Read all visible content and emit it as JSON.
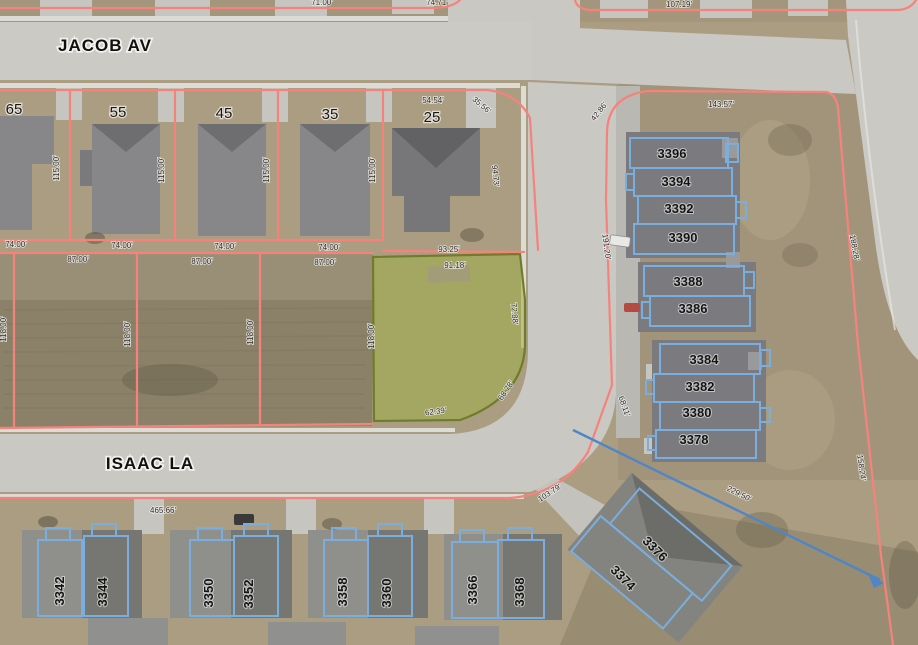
{
  "colors": {
    "parcel_line": "#f5837c",
    "selected_parcel_fill": "#9fae49",
    "selected_parcel_outline": "#6f7d28",
    "building_outline": "#7aaede",
    "measure_line": "#4e86c8",
    "street_label": "#101010",
    "dimension_label": "#2b2b2b"
  },
  "labels": {
    "streets": [
      {
        "text": "JACOB AV",
        "x": 105,
        "y": 51,
        "rot": 0
      },
      {
        "text": "ISAAC LA",
        "x": 150,
        "y": 469,
        "rot": 0
      }
    ],
    "lots": [
      {
        "text": "65",
        "x": 14,
        "y": 114,
        "rot": 0
      },
      {
        "text": "55",
        "x": 118,
        "y": 117,
        "rot": 0
      },
      {
        "text": "45",
        "x": 224,
        "y": 118,
        "rot": 0
      },
      {
        "text": "35",
        "x": 330,
        "y": 119,
        "rot": 0
      },
      {
        "text": "25",
        "x": 432,
        "y": 122,
        "rot": 0
      }
    ],
    "buildings": [
      {
        "text": "3396",
        "x": 672,
        "y": 158,
        "rot": 0
      },
      {
        "text": "3394",
        "x": 676,
        "y": 186,
        "rot": 0
      },
      {
        "text": "3392",
        "x": 679,
        "y": 213,
        "rot": 0
      },
      {
        "text": "3390",
        "x": 683,
        "y": 242,
        "rot": 0
      },
      {
        "text": "3388",
        "x": 688,
        "y": 286,
        "rot": 0
      },
      {
        "text": "3386",
        "x": 693,
        "y": 313,
        "rot": 0
      },
      {
        "text": "3384",
        "x": 704,
        "y": 364,
        "rot": 0
      },
      {
        "text": "3382",
        "x": 700,
        "y": 391,
        "rot": 0
      },
      {
        "text": "3380",
        "x": 697,
        "y": 417,
        "rot": 0
      },
      {
        "text": "3378",
        "x": 694,
        "y": 444,
        "rot": 0
      },
      {
        "text": "3376",
        "x": 652,
        "y": 552,
        "rot": 45
      },
      {
        "text": "3374",
        "x": 620,
        "y": 581,
        "rot": 45
      },
      {
        "text": "3342",
        "x": 64,
        "y": 591,
        "rot": -90
      },
      {
        "text": "3344",
        "x": 107,
        "y": 592,
        "rot": -90
      },
      {
        "text": "3350",
        "x": 213,
        "y": 593,
        "rot": -90
      },
      {
        "text": "3352",
        "x": 253,
        "y": 594,
        "rot": -90
      },
      {
        "text": "3358",
        "x": 347,
        "y": 592,
        "rot": -90
      },
      {
        "text": "3360",
        "x": 391,
        "y": 593,
        "rot": -90
      },
      {
        "text": "3366",
        "x": 477,
        "y": 590,
        "rot": -90
      },
      {
        "text": "3368",
        "x": 524,
        "y": 592,
        "rot": -90
      }
    ],
    "dimensions": [
      {
        "text": "71.00'",
        "x": 322,
        "y": 5,
        "rot": 0
      },
      {
        "text": "74.71'",
        "x": 437,
        "y": 5,
        "rot": 0
      },
      {
        "text": "107.19'",
        "x": 679,
        "y": 7,
        "rot": 0
      },
      {
        "text": "54.54'",
        "x": 433,
        "y": 103,
        "rot": 0
      },
      {
        "text": "35.56'",
        "x": 480,
        "y": 107,
        "rot": 40
      },
      {
        "text": "94.73'",
        "x": 493,
        "y": 176,
        "rot": 85
      },
      {
        "text": "115.00'",
        "x": 59,
        "y": 168,
        "rot": -90
      },
      {
        "text": "115.00'",
        "x": 164,
        "y": 170,
        "rot": -90
      },
      {
        "text": "115.00'",
        "x": 269,
        "y": 170,
        "rot": -90
      },
      {
        "text": "115.00'",
        "x": 375,
        "y": 170,
        "rot": -90
      },
      {
        "text": "74.00'",
        "x": 16,
        "y": 247,
        "rot": 0
      },
      {
        "text": "74.00'",
        "x": 122,
        "y": 248,
        "rot": 0
      },
      {
        "text": "74.00'",
        "x": 225,
        "y": 249,
        "rot": 0
      },
      {
        "text": "74.00'",
        "x": 329,
        "y": 250,
        "rot": 0
      },
      {
        "text": "87.00'",
        "x": 78,
        "y": 262,
        "rot": 0
      },
      {
        "text": "87.00'",
        "x": 202,
        "y": 264,
        "rot": 0
      },
      {
        "text": "87.00'",
        "x": 325,
        "y": 265,
        "rot": 0
      },
      {
        "text": "118.00'",
        "x": 6,
        "y": 329,
        "rot": -90
      },
      {
        "text": "118.00'",
        "x": 130,
        "y": 334,
        "rot": -90
      },
      {
        "text": "118.00'",
        "x": 253,
        "y": 332,
        "rot": -90
      },
      {
        "text": "118.00'",
        "x": 374,
        "y": 336,
        "rot": -90
      },
      {
        "text": "93.25'",
        "x": 449,
        "y": 252,
        "rot": 0
      },
      {
        "text": "91.18'",
        "x": 455,
        "y": 268,
        "rot": 0
      },
      {
        "text": "72.88'",
        "x": 512,
        "y": 314,
        "rot": 85
      },
      {
        "text": "68.78'",
        "x": 508,
        "y": 392,
        "rot": -55
      },
      {
        "text": "62.39'",
        "x": 436,
        "y": 414,
        "rot": -8
      },
      {
        "text": "42.86'",
        "x": 601,
        "y": 113,
        "rot": -52
      },
      {
        "text": "143.57'",
        "x": 721,
        "y": 107,
        "rot": 0
      },
      {
        "text": "191.20'",
        "x": 604,
        "y": 247,
        "rot": 83
      },
      {
        "text": "188.28'",
        "x": 852,
        "y": 248,
        "rot": 80
      },
      {
        "text": "68.11'",
        "x": 622,
        "y": 407,
        "rot": 70
      },
      {
        "text": "103.79'",
        "x": 551,
        "y": 495,
        "rot": -33
      },
      {
        "text": "229.50'",
        "x": 738,
        "y": 496,
        "rot": 26
      },
      {
        "text": "158.24'",
        "x": 859,
        "y": 468,
        "rot": 82
      },
      {
        "text": "465.66'",
        "x": 163,
        "y": 513,
        "rot": 0
      }
    ]
  }
}
